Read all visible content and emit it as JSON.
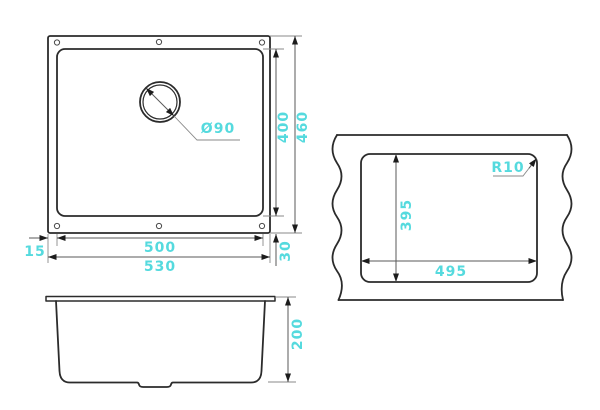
{
  "accent_color": "#55dade",
  "line_color": "#2b2b2b",
  "drawing_title": "sink-dimension-drawing",
  "drawing": {
    "top_view": {
      "inner_width": "500",
      "outer_width": "530",
      "left_offset": "15",
      "inner_height": "400",
      "outer_height": "460",
      "bottom_offset": "30",
      "drain_diameter": "Ø90"
    },
    "cutout_view": {
      "cutout_width": "495",
      "cutout_height": "395",
      "corner_radius": "R10"
    },
    "side_view": {
      "depth": "200"
    }
  }
}
